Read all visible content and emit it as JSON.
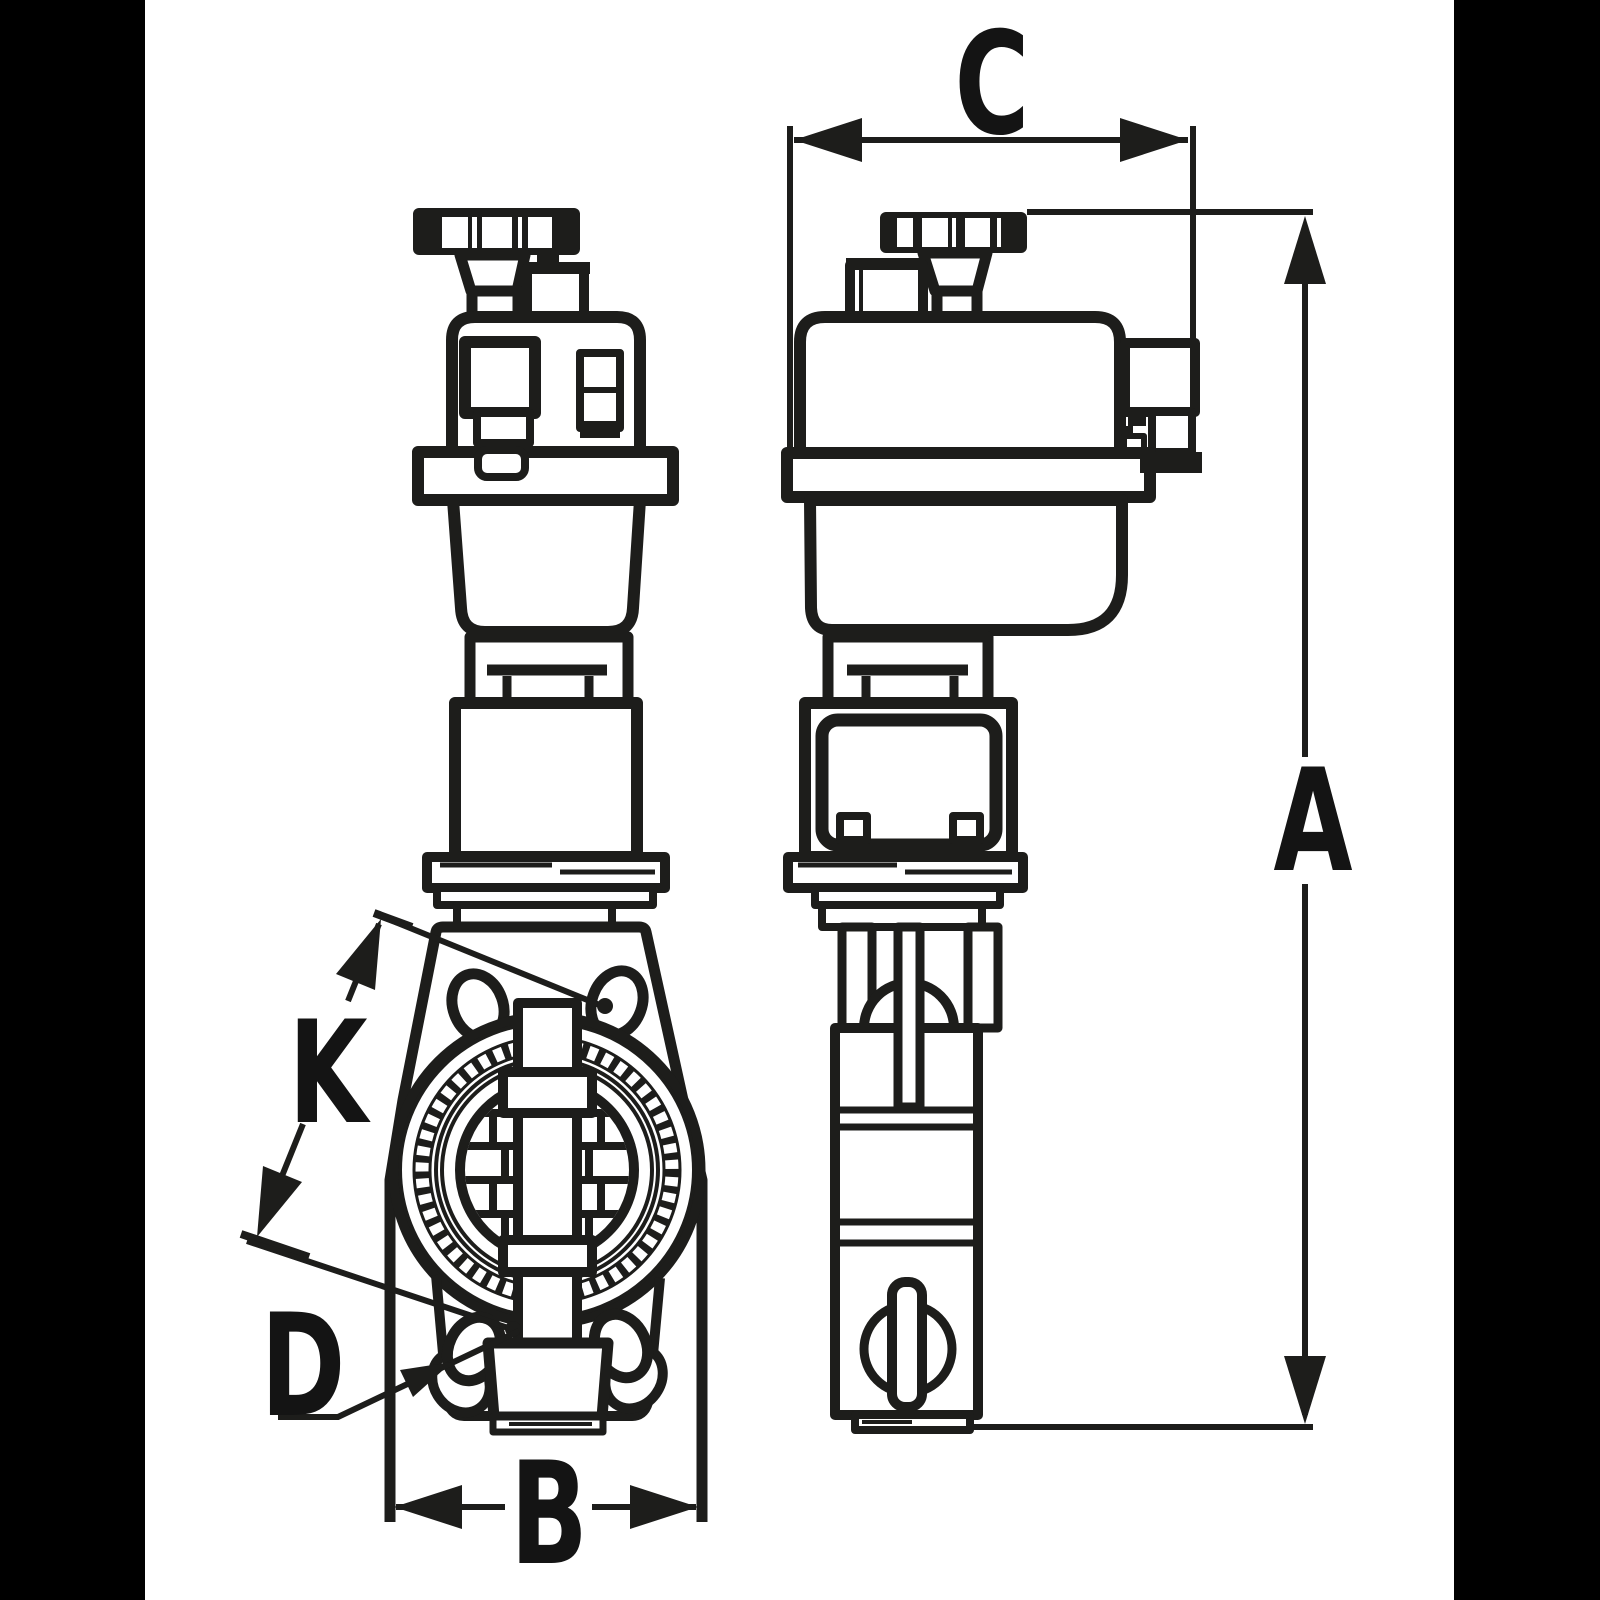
{
  "drawing": {
    "title": "valve-actuator-dimension-drawing",
    "labels": {
      "a": "A",
      "b": "B",
      "c": "C",
      "d": "D",
      "k": "K"
    },
    "colors": {
      "ink": "#1d1d1b",
      "paper": "#ffffff",
      "letterbox": "#000000",
      "label": "#141414"
    }
  }
}
